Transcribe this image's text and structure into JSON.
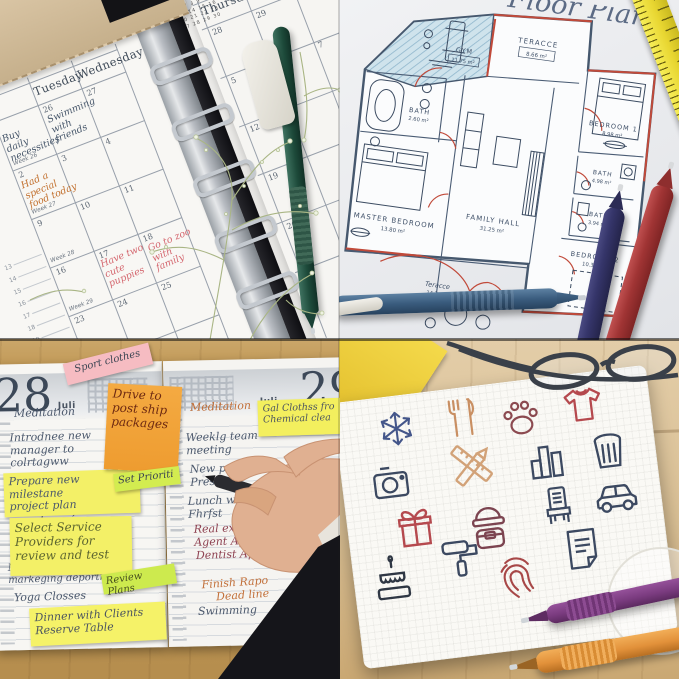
{
  "collage": {
    "description": "Four-photo collage: gel pens with weekly planner, floor plan, daily planner with sticky notes, and doodle icon sheet"
  },
  "q1": {
    "mini_calendar": {
      "month": "June",
      "dow": "M T W T F S S",
      "rows": [
        "1 2",
        "3 4 5 6 7 8 9",
        "10 11 12 13 14 15 16",
        "17 18 19 20 21 22 23",
        "24 25 26 27 28 29 30"
      ]
    },
    "day_headers": {
      "monday": "Monday",
      "tuesday": "Tuesday",
      "wednesday": "Wednesday",
      "thursday": "Thursday",
      "friday": "Friday"
    },
    "dates": [
      "26",
      "27",
      "28",
      "29",
      "2",
      "3",
      "4",
      "5",
      "7",
      "9",
      "10",
      "11",
      "12",
      "16",
      "17",
      "18",
      "19",
      "23",
      "24",
      "25",
      "26"
    ],
    "week_labels": [
      "Week 26",
      "Week 27",
      "Week 28",
      "Week 29"
    ],
    "margin_numbers": [
      "13",
      "14",
      "15",
      "16",
      "17",
      "18",
      "19",
      "20",
      "21"
    ],
    "entries": [
      {
        "text": "Buy daily\nnecessities"
      },
      {
        "text": "Swimming\nwith friends"
      },
      {
        "text": "Had a special\nfood today"
      },
      {
        "text": "Have two\ncute puppies"
      },
      {
        "text": "Go to zoo\nwith family"
      }
    ]
  },
  "q2": {
    "title": "Floor Plan",
    "rooms": [
      {
        "name": "GYM",
        "area": "11.75 m²"
      },
      {
        "name": "TERACCE",
        "area": "8.66 m²"
      },
      {
        "name": "BATH",
        "area": "2.60 m²"
      },
      {
        "name": "MASTER BEDROOM",
        "area": "13.80 m²"
      },
      {
        "name": "FAMILY HALL",
        "area": "31.25 m²"
      },
      {
        "name": "BEDROOM 1",
        "area": "8.98 m²"
      },
      {
        "name": "BATH",
        "area": "4.98 m²"
      },
      {
        "name": "BATH",
        "area": "3.94 m²"
      },
      {
        "name": "BEDROOM 2",
        "area": "10.37 m²"
      },
      {
        "name": "Teracce",
        "area": "14.3 m²"
      }
    ]
  },
  "q3": {
    "left_page": {
      "day_number": "28",
      "month": "Juli"
    },
    "right_page": {
      "day_number": "29",
      "month": "Juli"
    },
    "left_entries": [
      "Meditation",
      "Introdnee new\nmanager to\ncolrtagww",
      "Prepare new milestane\nproject plan",
      "Pickup car from Dealer",
      "Nceting with\nmarkeging deportment",
      "Yoga Closses"
    ],
    "right_entries": [
      "Meditation",
      "Weeklg team\nmeeting",
      "New pro\nPrese",
      "Lunch w\nFhrfst",
      "Real ex\nAgent Ap",
      "Dentist Ap",
      "Finish Rapo\nDead line",
      "Swimming"
    ],
    "stickies": {
      "pink": "Sport clothes",
      "orange": "Drive to\npost ship\npackages",
      "tab1": "Set Prioriti",
      "yellow1": "Select Service\nProviders for\nreview and test",
      "tab2": "Review  Plans",
      "yellow2": "Dinner with Clients\nReserve Table",
      "yellow3": "Gal Clothss fro\nChemical clea"
    }
  },
  "q4": {
    "icons": [
      "snowflake",
      "fork-and-knife",
      "paw-print",
      "t-shirt",
      "camera",
      "ruler-and-pencil",
      "bar-chart",
      "trash-can",
      "gift-box",
      "beanie-and-handbag",
      "chair",
      "car",
      "birthday-cake",
      "paint-roller",
      "fingerprint",
      "document"
    ]
  },
  "colors": {
    "green_pen": "#1d4a3a",
    "blue_pen": "#3a5c7e",
    "navy_pen": "#35356a",
    "red_pen": "#a03434",
    "purple_pen": "#7a3b7f",
    "orange_pen": "#e2913a",
    "plan_wall": "#46586e",
    "plan_red": "#c14a3a",
    "sticky_yellow": "#f3f067",
    "sticky_orange": "#f0a43c",
    "sticky_pink": "#f6bcc2",
    "sticky_green": "#d3ec50",
    "handwriting_blue": "#4b586c",
    "handwriting_orange": "#c2703a",
    "handwriting_pink": "#d4666e",
    "ruler_yellow": "#e8d631"
  }
}
